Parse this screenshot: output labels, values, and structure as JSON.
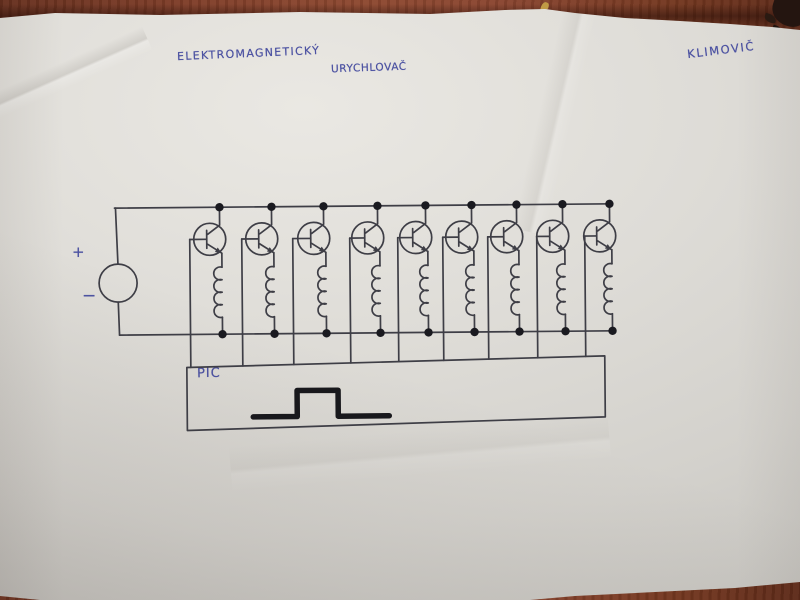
{
  "scene": {
    "setting": "photograph of a hand-drawn circuit schematic on a white paper sheet lying on a reddish-brown wooden table",
    "paper_color": "#dedcd7",
    "table_color": "#7c3b27"
  },
  "handwriting": {
    "title_line1": "ELEKTROMAGNETICKÝ",
    "title_line2": "URYCHLOVAČ",
    "author_signature": "KLIMOVIČ",
    "pen_color": "#4d53a2"
  },
  "schematic": {
    "type": "circuit-diagram",
    "subject": "nine-stage electromagnetic accelerator driver: DC source across two rails, nine parallel transistor+coil branches, transistor bases driven by a PIC controller that outputs a square pulse",
    "ink_color": "#3e3e46",
    "dot_color": "#1a1a20",
    "marker_color": "#17171b",
    "dc_source": {
      "label_plus": "+",
      "label_minus": "−",
      "cx": 118,
      "cy": 281,
      "r": 19
    },
    "rails": {
      "top_y": 206,
      "bottom_y": 333,
      "x_start": 115,
      "x_end": 613
    },
    "stages": [
      {
        "n": 1,
        "collector_x": 220,
        "base_x": 190
      },
      {
        "n": 2,
        "collector_x": 272,
        "base_x": 242
      },
      {
        "n": 3,
        "collector_x": 324,
        "base_x": 293
      },
      {
        "n": 4,
        "collector_x": 378,
        "base_x": 350
      },
      {
        "n": 5,
        "collector_x": 426,
        "base_x": 398
      },
      {
        "n": 6,
        "collector_x": 472,
        "base_x": 443
      },
      {
        "n": 7,
        "collector_x": 517,
        "base_x": 488
      },
      {
        "n": 8,
        "collector_x": 563,
        "base_x": 537
      },
      {
        "n": 9,
        "collector_x": 610,
        "base_x": 585
      }
    ],
    "controller": {
      "label": "PIC",
      "box_points": [
        [
          186,
          366
        ],
        [
          604,
          358
        ],
        [
          604,
          419
        ],
        [
          186,
          429
        ]
      ]
    },
    "pulse_waveform": {
      "points": [
        [
          252,
          416
        ],
        [
          296,
          416
        ],
        [
          296,
          390
        ],
        [
          337,
          390
        ],
        [
          337,
          416
        ],
        [
          388,
          416
        ]
      ],
      "stroke_width": 5.5
    }
  }
}
